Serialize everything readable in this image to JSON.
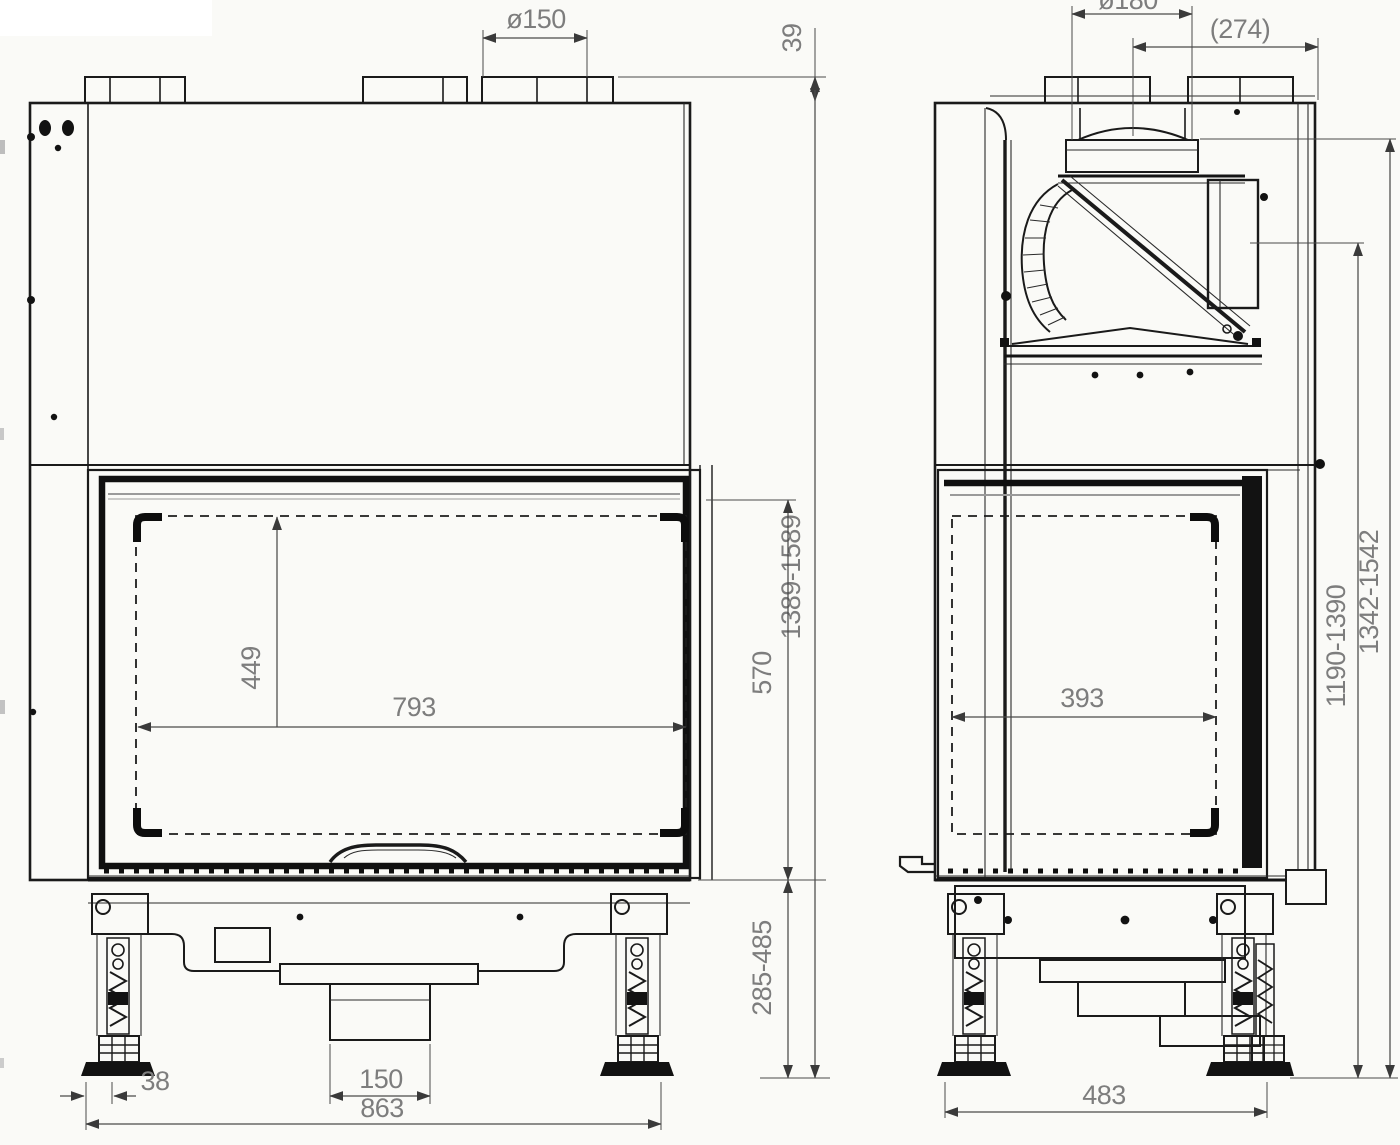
{
  "drawing": {
    "title": "fireplace-insert-dimension-drawing",
    "colors": {
      "line": "#1a1a1a",
      "dim_text": "#7d7d7d",
      "background": "#fafaf7"
    },
    "front_view": {
      "label": "front view",
      "dims": {
        "flue_diameter": "ø150",
        "collar_offset": "39",
        "overall_height": "1389-1589",
        "door_height": "570",
        "plinth_height": "285-485",
        "glass_height": "449",
        "glass_width": "793",
        "foot_offset": "38",
        "intake_width": "150",
        "foot_span": "863"
      }
    },
    "side_view": {
      "label": "side view",
      "dims": {
        "flue_diameter": "ø180",
        "flue_center_to_back": "(274)",
        "side_glass_width": "393",
        "height_to_window": "1190-1390",
        "height_to_top": "1342-1542",
        "foot_span": "483"
      }
    }
  }
}
